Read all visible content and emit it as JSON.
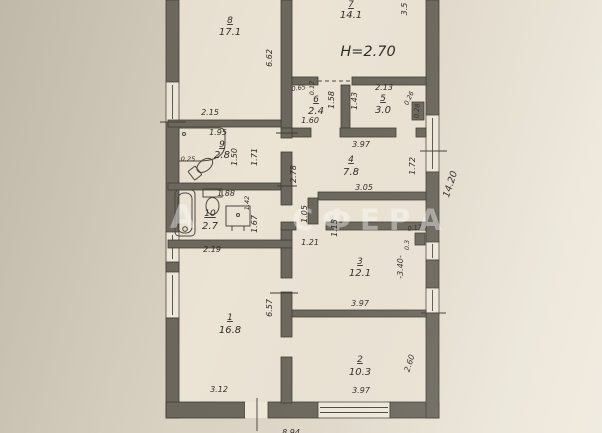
{
  "colors": {
    "wall": "#6b675d",
    "paper": "#d9d1c2",
    "floor": "#ebe4d5",
    "ink": "#2f2c26"
  },
  "watermark": {
    "left": "А",
    "right": "СФЕРА"
  },
  "rooms": {
    "r1": {
      "num": "1",
      "area": "16.8"
    },
    "r2": {
      "num": "2",
      "area": "10.3"
    },
    "r3": {
      "num": "3",
      "area": "12.1"
    },
    "r4": {
      "num": "4",
      "area": "7.8"
    },
    "r5": {
      "num": "5",
      "area": "3.0"
    },
    "r6": {
      "num": "6",
      "area": "2.4"
    },
    "r7": {
      "num": "7",
      "area": "14.1"
    },
    "r8": {
      "num": "8",
      "area": "17.1"
    },
    "r9": {
      "num": "9",
      "area": "2.8"
    },
    "r10": {
      "num": "10",
      "area": "2.7"
    }
  },
  "dims": {
    "h270": "H=2.70",
    "d662": "6.62",
    "d35": "3.5",
    "d215": "2.15",
    "d195": "1.95",
    "d025": "0.25",
    "d150": "1.50",
    "d171": "1.71",
    "d065": "0.65",
    "d017a": "0.17",
    "d158": "1.58",
    "d160": "1.60",
    "d143": "1.43",
    "d213": "2.13",
    "d026": "0.26",
    "d028": "0.28",
    "d397a": "3.97",
    "d278": "2.78",
    "d172": "1.72",
    "d305": "3.05",
    "d105": "1.05",
    "d113": "1.13",
    "d121": "1.21",
    "d017b": "0.17",
    "d03": "0.3",
    "d340": "-3.40-",
    "d1420": "14.20",
    "d188": "1.88",
    "d142": "1.42",
    "d167": "1.67",
    "d219": "2.19",
    "d657": "6.57",
    "d397b": "3.97",
    "d260": "2.60",
    "d312": "3.12",
    "d397c": "3.97",
    "d894": "8.94"
  }
}
